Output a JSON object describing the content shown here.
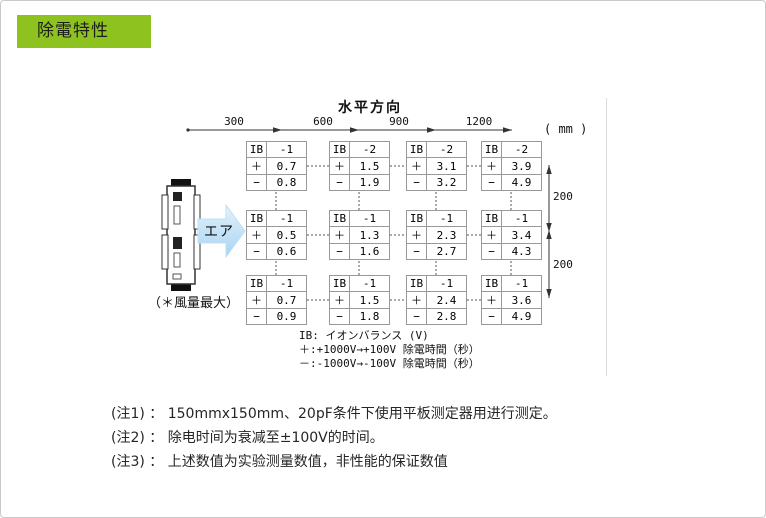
{
  "header": {
    "title": "除電特性",
    "accent_color": "#8dc21f"
  },
  "diagram": {
    "axis_title": "水平方向",
    "unit_label": "( mm )",
    "horizontal_distances": [
      "300",
      "600",
      "900",
      "1200"
    ],
    "vertical_distances": [
      "200",
      "200"
    ],
    "air_label": "エア",
    "air_note": "（＊風量最大）",
    "row_labels": {
      "ib": "IB",
      "plus": "＋",
      "minus": "−"
    },
    "measurements": {
      "rows": [
        {
          "cells": [
            {
              "ib": "-1",
              "plus": "0.7",
              "minus": "0.8"
            },
            {
              "ib": "-2",
              "plus": "1.5",
              "minus": "1.9"
            },
            {
              "ib": "-2",
              "plus": "3.1",
              "minus": "3.2"
            },
            {
              "ib": "-2",
              "plus": "3.9",
              "minus": "4.9"
            }
          ]
        },
        {
          "cells": [
            {
              "ib": "-1",
              "plus": "0.5",
              "minus": "0.6"
            },
            {
              "ib": "-1",
              "plus": "1.3",
              "minus": "1.6"
            },
            {
              "ib": "-1",
              "plus": "2.3",
              "minus": "2.7"
            },
            {
              "ib": "-1",
              "plus": "3.4",
              "minus": "4.3"
            }
          ]
        },
        {
          "cells": [
            {
              "ib": "-1",
              "plus": "0.7",
              "minus": "0.9"
            },
            {
              "ib": "-1",
              "plus": "1.5",
              "minus": "1.8"
            },
            {
              "ib": "-1",
              "plus": "2.4",
              "minus": "2.8"
            },
            {
              "ib": "-1",
              "plus": "3.6",
              "minus": "4.9"
            }
          ]
        }
      ]
    },
    "legend": [
      "IB: イオンバランス (V)",
      "＋:+1000V→+100V 除電時間（秒）",
      "－:-1000V→-100V 除電時間（秒）"
    ]
  },
  "notes": [
    "(注1) ： 150mmx150mm、20pF条件下使用平板测定器用进行测定。",
    "(注2) ： 除电时间为衰减至±100V的时间。",
    "(注3) ： 上述数值为实验测量数值，非性能的保证数值"
  ]
}
